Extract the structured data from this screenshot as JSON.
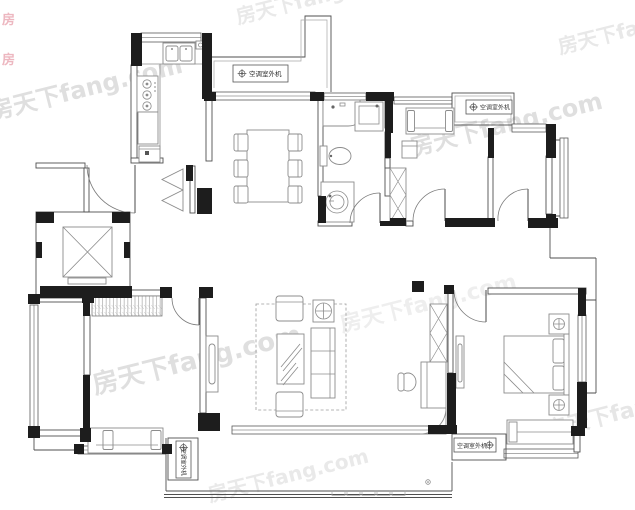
{
  "floor_plan": {
    "kind": "residential apartment floor plan"
  },
  "watermark": {
    "text": "房天下fang.com",
    "color": "#dcdcdc"
  },
  "corner_logo": {
    "text": "房",
    "color": "#e9a6b1"
  },
  "ac_unit": {
    "label": "空调室外机",
    "count": 4
  },
  "palette": {
    "background": "#ffffff",
    "wall": "#1d1d1d",
    "wall_line": "#4f4f4f",
    "window_line": "#5a5a5a",
    "furniture_line": "#8c8c8c",
    "label_text": "#2f2f2f",
    "watermark": "#dcdcdc"
  }
}
